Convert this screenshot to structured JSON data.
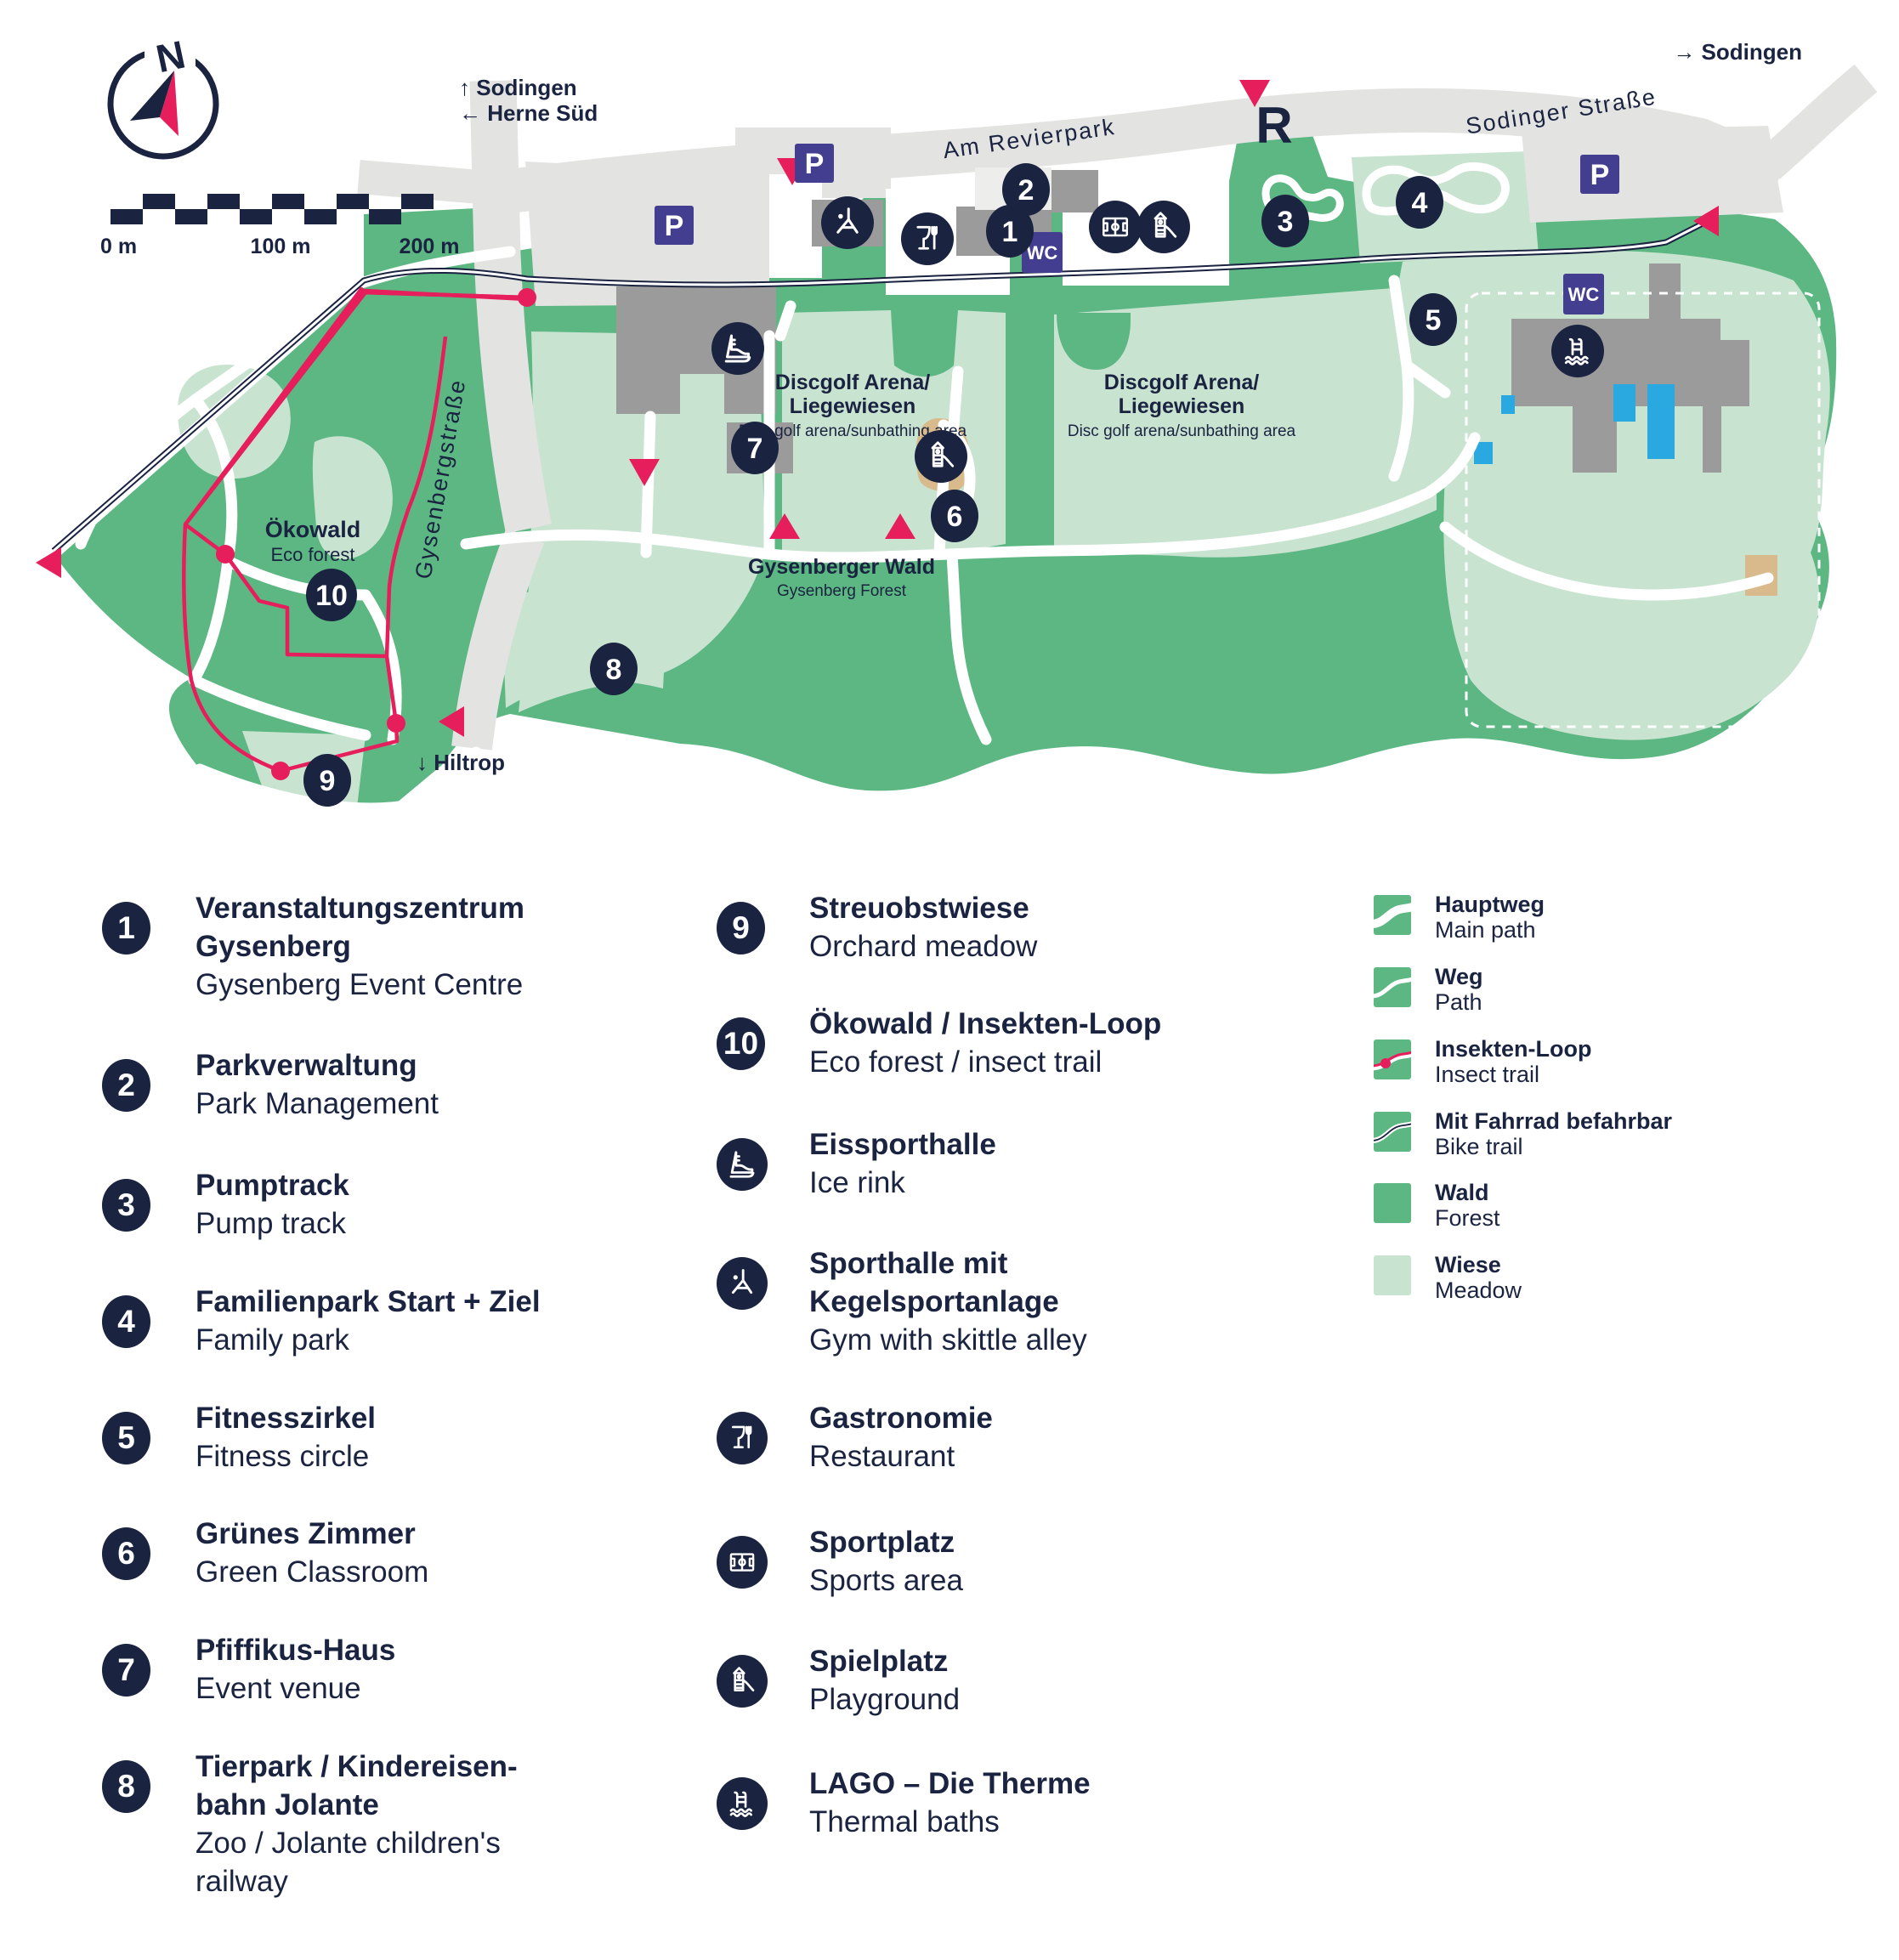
{
  "colors": {
    "navy": "#1A2340",
    "forest_green": "#5CB783",
    "meadow_green": "#C9E3D1",
    "road_gray": "#E3E3E1",
    "building_gray": "#9B9B9B",
    "accent_pink": "#E61E5C",
    "purple": "#433E90",
    "pool_blue": "#29A9E0",
    "sand_tan": "#D9BA8C"
  },
  "compass": {
    "north_label": "N"
  },
  "scale_bar": {
    "labels": [
      "0 m",
      "100 m",
      "200 m"
    ]
  },
  "map": {
    "direction_labels": {
      "top_left_1": "↑ Sodingen",
      "top_left_2": "← Herne Süd",
      "top_right": "→ Sodingen",
      "bottom": "↓ Hiltrop"
    },
    "street_labels": {
      "am_revierpark": "Am Revierpark",
      "sodinger_strasse": "Sodinger Straße",
      "gysenbergstrasse": "Gysenbergstraße"
    },
    "area_labels": {
      "oekowald": {
        "de": "Ökowald",
        "en": "Eco forest"
      },
      "discgolf_west": {
        "de1": "Discgolf Arena/",
        "de2": "Liegewiesen",
        "en": "Disc golf arena/sunbathing area"
      },
      "discgolf_east": {
        "de1": "Discgolf Arena/",
        "de2": "Liegewiesen",
        "en": "Disc golf arena/sunbathing area"
      },
      "gysenberger_wald": {
        "de": "Gysenberger Wald",
        "en": "Gysenberg Forest"
      }
    },
    "revierpark_logo": "R",
    "parking_label": "P",
    "wc_label": "WC",
    "markers": [
      {
        "num": "1"
      },
      {
        "num": "2"
      },
      {
        "num": "3"
      },
      {
        "num": "4"
      },
      {
        "num": "5"
      },
      {
        "num": "6"
      },
      {
        "num": "7"
      },
      {
        "num": "8"
      },
      {
        "num": "9"
      },
      {
        "num": "10"
      }
    ]
  },
  "legend": {
    "numbered_items": [
      {
        "num": "1",
        "de_lines": [
          "Veranstaltungszentrum",
          "Gysenberg"
        ],
        "en_lines": [
          "Gysenberg Event Centre"
        ]
      },
      {
        "num": "2",
        "de_lines": [
          "Parkverwaltung"
        ],
        "en_lines": [
          "Park Management"
        ]
      },
      {
        "num": "3",
        "de_lines": [
          "Pumptrack"
        ],
        "en_lines": [
          "Pump track"
        ]
      },
      {
        "num": "4",
        "de_lines": [
          "Familienpark Start + Ziel"
        ],
        "en_lines": [
          "Family park"
        ]
      },
      {
        "num": "5",
        "de_lines": [
          "Fitnesszirkel"
        ],
        "en_lines": [
          "Fitness circle"
        ]
      },
      {
        "num": "6",
        "de_lines": [
          "Grünes Zimmer"
        ],
        "en_lines": [
          "Green Classroom"
        ]
      },
      {
        "num": "7",
        "de_lines": [
          "Pfiffikus-Haus"
        ],
        "en_lines": [
          "Event venue"
        ]
      },
      {
        "num": "8",
        "de_lines": [
          "Tierpark / Kindereisen-",
          "bahn Jolante"
        ],
        "en_lines": [
          "Zoo / Jolante children's",
          "railway"
        ]
      },
      {
        "num": "9",
        "de_lines": [
          "Streuobstwiese"
        ],
        "en_lines": [
          "Orchard meadow"
        ]
      },
      {
        "num": "10",
        "de_lines": [
          "Ökowald / Insekten-Loop"
        ],
        "en_lines": [
          "Eco forest / insect trail"
        ]
      }
    ],
    "icon_items": [
      {
        "icon": "ice-skate-icon",
        "de_lines": [
          "Eissporthalle"
        ],
        "en_lines": [
          "Ice rink"
        ]
      },
      {
        "icon": "gym-icon",
        "de_lines": [
          "Sporthalle mit",
          "Kegelsportanlage"
        ],
        "en_lines": [
          "Gym with skittle alley"
        ]
      },
      {
        "icon": "restaurant-icon",
        "de_lines": [
          "Gastronomie"
        ],
        "en_lines": [
          "Restaurant"
        ]
      },
      {
        "icon": "sports-field-icon",
        "de_lines": [
          "Sportplatz"
        ],
        "en_lines": [
          "Sports area"
        ]
      },
      {
        "icon": "playground-icon",
        "de_lines": [
          "Spielplatz"
        ],
        "en_lines": [
          "Playground"
        ]
      },
      {
        "icon": "thermal-baths-icon",
        "de_lines": [
          "LAGO – Die Therme"
        ],
        "en_lines": [
          "Thermal baths"
        ]
      }
    ],
    "swatch_items": [
      {
        "type": "main-path",
        "de": "Hauptweg",
        "en": "Main path"
      },
      {
        "type": "path",
        "de": "Weg",
        "en": "Path"
      },
      {
        "type": "insect-trail",
        "de": "Insekten-Loop",
        "en": "Insect trail"
      },
      {
        "type": "bike-trail",
        "de": "Mit Fahrrad befahrbar",
        "en": "Bike trail"
      },
      {
        "type": "forest",
        "de": "Wald",
        "en": "Forest"
      },
      {
        "type": "meadow",
        "de": "Wiese",
        "en": "Meadow"
      }
    ]
  }
}
